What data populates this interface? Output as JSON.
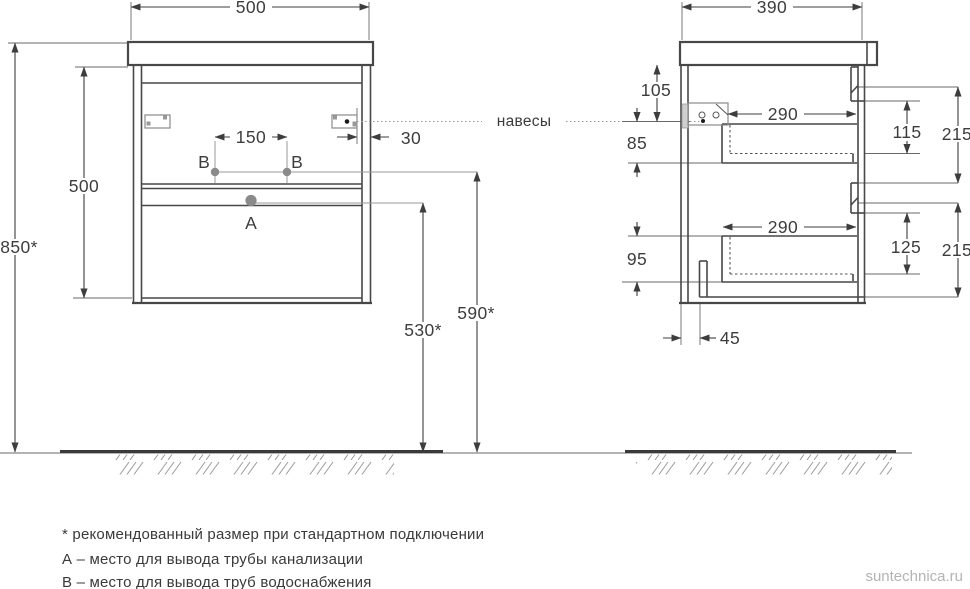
{
  "watermark": "suntechnica.ru",
  "callouts": {
    "hangers": "навесы",
    "hole_a": "А",
    "hole_b": "В"
  },
  "front_view": {
    "cabinet_width": "500",
    "carcass_height": "500",
    "total_height": "850*",
    "holes_spacing": "150",
    "hinge_offset": "30",
    "drain_height": "530*",
    "supply_height": "590*"
  },
  "side_view": {
    "cabinet_depth": "390",
    "top_gap": "105",
    "hanger_drop": "85",
    "bottom_gap": "95",
    "drawer_top_depth": "290",
    "drawer_bottom_depth": "290",
    "inner_top": "115",
    "front_top": "215",
    "inner_bottom": "125",
    "front_bottom": "215",
    "pipe_offset": "45"
  },
  "legend": {
    "note_star": "* рекомендованный размер при стандартном подключении",
    "note_a": "А – место для вывода трубы канализации",
    "note_b": "В – место для вывода труб водоснабжения"
  },
  "colors": {
    "line": "#474747",
    "aux": "#9a9a9a",
    "text": "#3d3d3d",
    "watermark": "#b3b3b3"
  }
}
